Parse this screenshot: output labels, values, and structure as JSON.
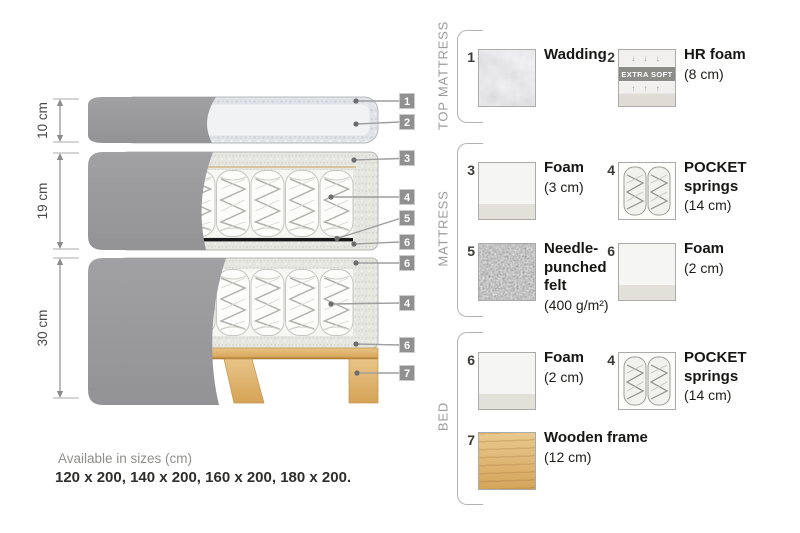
{
  "diagram": {
    "dimensions": [
      {
        "label": "10 cm"
      },
      {
        "label": "19 cm"
      },
      {
        "label": "30 cm"
      }
    ],
    "callouts": [
      "1",
      "2",
      "3",
      "4",
      "5",
      "6",
      "6",
      "4",
      "6",
      "7"
    ]
  },
  "legend": {
    "sections": [
      {
        "label": "TOP MATTRESS",
        "items": [
          {
            "num": "1",
            "title": "Wadding",
            "size": "",
            "swatch": "wadding"
          },
          {
            "num": "2",
            "title": "HR foam",
            "size": "(8 cm)",
            "swatch": "hr-foam",
            "badge": "EXTRA SOFT",
            "arrows_down": "↓ ↓ ↓",
            "arrows_up": "↑ ↑ ↑"
          }
        ]
      },
      {
        "label": "MATTRESS",
        "items": [
          {
            "num": "3",
            "title": "Foam",
            "size": "(3 cm)",
            "swatch": "foam"
          },
          {
            "num": "4",
            "title": "POCKET\nsprings",
            "size": "(14 cm)",
            "swatch": "pocket-springs"
          },
          {
            "num": "5",
            "title": "Needle-\npunched\nfelt",
            "size": "(400 g/m²)",
            "swatch": "felt"
          },
          {
            "num": "6",
            "title": "Foam",
            "size": "(2 cm)",
            "swatch": "foam"
          }
        ]
      },
      {
        "label": "BED",
        "items": [
          {
            "num": "6",
            "title": "Foam",
            "size": "(2 cm)",
            "swatch": "foam"
          },
          {
            "num": "4",
            "title": "POCKET\nsprings",
            "size": "(14 cm)",
            "swatch": "pocket-springs"
          },
          {
            "num": "7",
            "title": "Wooden frame",
            "size": "(12 cm)",
            "swatch": "wood"
          }
        ]
      }
    ]
  },
  "footer": {
    "sizes_caption": "Available in sizes (cm)",
    "sizes_list": "120 x 200, 140 x 200, 160 x 200, 180 x 200."
  },
  "colors": {
    "cover_gray": "#9b9b9d",
    "wood": "#ddab62",
    "felt_dark": "#5a5a5a",
    "section_label_gray": "#9b9b9b",
    "callout_gray": "#8f8f8f"
  }
}
